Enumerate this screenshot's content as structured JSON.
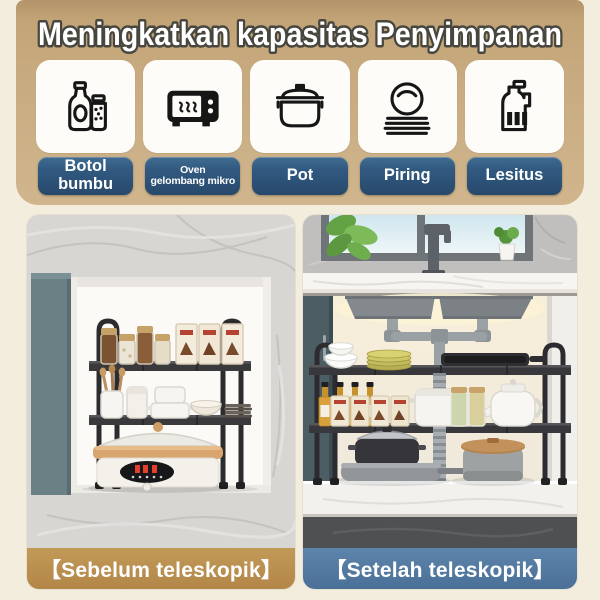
{
  "header": {
    "title": "Meningkatkan kapasitas Penyimpanan"
  },
  "features": [
    {
      "label": "Botol\nbumbu",
      "icon": "spice-bottles-icon"
    },
    {
      "label": "Oven\ngelombang mikro",
      "icon": "microwave-icon"
    },
    {
      "label": "Pot",
      "icon": "pot-icon"
    },
    {
      "label": "Piring",
      "icon": "plates-icon"
    },
    {
      "label": "Lesitus",
      "icon": "jug-icon"
    }
  ],
  "comparison": {
    "before": {
      "caption": "【Sebelum teleskopik】"
    },
    "after": {
      "caption": "【Setelah teleskopik】"
    }
  },
  "colors": {
    "page_bg": "#f3edde",
    "banner_tan": "#c8ab80",
    "icon_card_bg": "#fdfcf9",
    "label_blue": "#2e5377",
    "caption_before_bg": "#b9904f",
    "caption_after_bg": "#527aa2",
    "title_text": "#ffffff",
    "title_outline": "#47473f",
    "rack_black": "#2c2c2f"
  }
}
